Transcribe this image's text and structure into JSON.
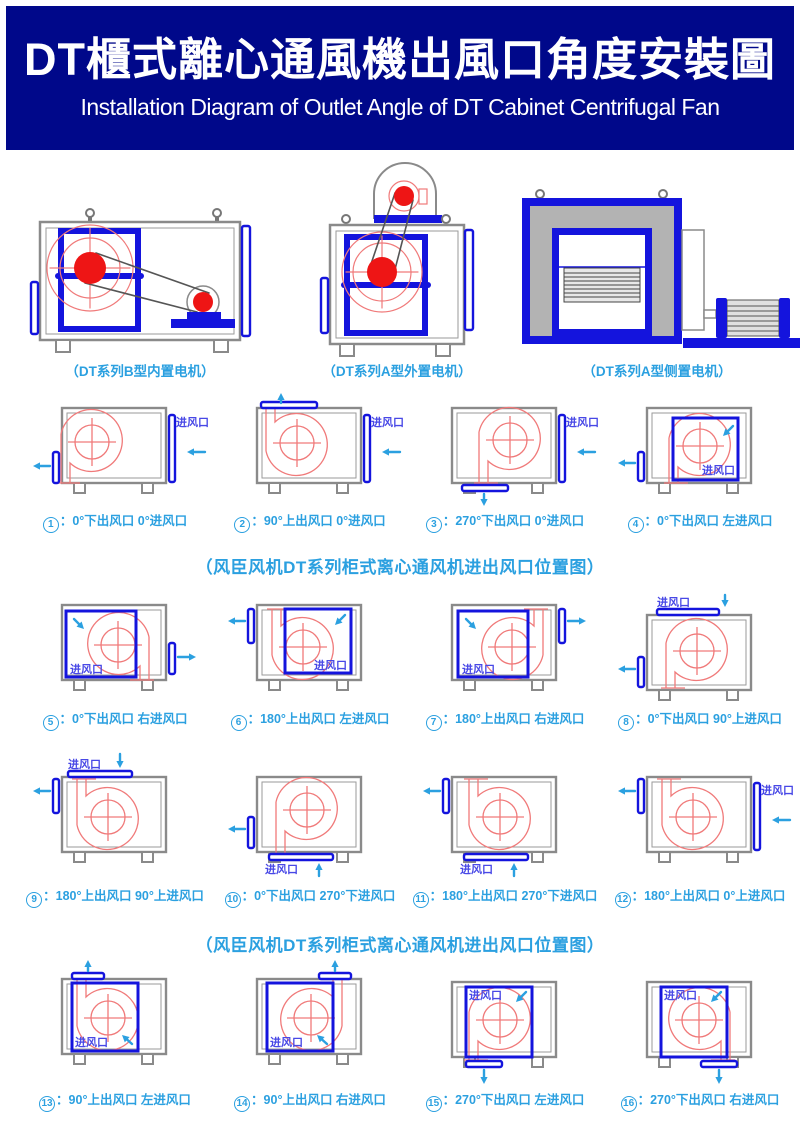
{
  "header": {
    "title_zh": "DT櫃式離心通風機出風口角度安裝圖",
    "subtitle_en": "Installation Diagram of Outlet Angle of DT Cabinet Centrifugal Fan"
  },
  "machine_captions": [
    "（DT系列B型内置电机）",
    "（DT系列A型外置电机）",
    "（DT系列A型侧置电机）"
  ],
  "section_title_mid": "（风臣风机DT系列柜式离心通风机进出风口位置图）",
  "section_title_bottom": "（风臣风机DT系列柜式离心通风机进出风口位置图）",
  "inlet_label": "进风口",
  "colors": {
    "header_bg": "#00088a",
    "caption_blue": "#2ba0e0",
    "port_blue": "#1414dd",
    "label_blue": "#4848e6",
    "scroll_red": "#f07a7a",
    "pulley_red": "#ee1515",
    "cabinet_gray": "#8a8a8a"
  },
  "diagrams": [
    {
      "n": "1",
      "cap": "0°下出风口 0°进风口",
      "row": 0,
      "col": 0,
      "cy": 16,
      "scroll": {
        "cx": 72,
        "cy": 50,
        "o": "bl",
        "dy": 41
      },
      "parts": [
        {
          "t": "vbar",
          "x": 33,
          "y": 60,
          "h": 31
        },
        {
          "t": "arrow",
          "x1": 30,
          "y1": 74,
          "x2": 13,
          "y2": 74
        },
        {
          "t": "vbar",
          "x": 149,
          "y": 23,
          "h": 67
        },
        {
          "t": "label",
          "x": 189,
          "y": 34,
          "a": "end"
        },
        {
          "t": "arrow",
          "x1": 185,
          "y1": 60,
          "x2": 167,
          "y2": 60
        }
      ]
    },
    {
      "n": "2",
      "cap": "90°上出风口 0°进风口",
      "row": 0,
      "col": 1,
      "cy": 16,
      "scroll": {
        "cx": 82,
        "cy": 51,
        "o": "tl",
        "dy": 41
      },
      "parts": [
        {
          "t": "hbar",
          "x": 46,
          "y": 10,
          "w": 56
        },
        {
          "t": "arrow",
          "x1": 66,
          "y1": 11,
          "x2": 66,
          "y2": 1
        },
        {
          "t": "vbar",
          "x": 149,
          "y": 23,
          "h": 67
        },
        {
          "t": "label",
          "x": 189,
          "y": 34,
          "a": "end"
        },
        {
          "t": "arrow",
          "x1": 185,
          "y1": 60,
          "x2": 167,
          "y2": 60
        }
      ]
    },
    {
      "n": "3",
      "cap": "270°下出风口 0°进风口",
      "row": 0,
      "col": 2,
      "cy": 16,
      "scroll": {
        "cx": 100,
        "cy": 48,
        "o": "bl",
        "dy": 43
      },
      "parts": [
        {
          "t": "hbar",
          "x": 52,
          "y": 93,
          "w": 46
        },
        {
          "t": "arrow",
          "x1": 74,
          "y1": 102,
          "x2": 74,
          "y2": 114
        },
        {
          "t": "vbar",
          "x": 149,
          "y": 23,
          "h": 67
        },
        {
          "t": "label",
          "x": 189,
          "y": 34,
          "a": "end"
        },
        {
          "t": "arrow",
          "x1": 185,
          "y1": 60,
          "x2": 167,
          "y2": 60
        }
      ]
    },
    {
      "n": "4",
      "cap": "0°下出风口 左进风口",
      "row": 0,
      "col": 3,
      "cy": 16,
      "scroll": {
        "cx": 95,
        "cy": 54,
        "o": "bl",
        "dy": 37
      },
      "parts": [
        {
          "t": "square",
          "x": 68,
          "y": 26,
          "w": 65,
          "h": 62
        },
        {
          "t": "label",
          "x": 130,
          "y": 82,
          "a": "end"
        },
        {
          "t": "diag",
          "x1": 128,
          "y1": 34,
          "x2": 118,
          "y2": 44
        },
        {
          "t": "vbar",
          "x": 33,
          "y": 60,
          "h": 29
        },
        {
          "t": "arrow",
          "x1": 30,
          "y1": 71,
          "x2": 13,
          "y2": 71
        }
      ]
    },
    {
      "n": "5",
      "cap": "0°下出风口 右进风口",
      "row": 1,
      "col": 0,
      "cy": 12,
      "scroll": {
        "cx": 98,
        "cy": 52,
        "o": "br",
        "dy": 35
      },
      "parts": [
        {
          "t": "square",
          "x": 46,
          "y": 18,
          "w": 70,
          "h": 66
        },
        {
          "t": "label",
          "x": 50,
          "y": 80,
          "a": "start"
        },
        {
          "t": "diag",
          "x1": 54,
          "y1": 26,
          "x2": 64,
          "y2": 36
        },
        {
          "t": "vbar",
          "x": 149,
          "y": 50,
          "h": 31
        },
        {
          "t": "arrow",
          "x1": 158,
          "y1": 64,
          "x2": 176,
          "y2": 64
        }
      ]
    },
    {
      "n": "6",
      "cap": "180°上出风口 左进风口",
      "row": 1,
      "col": 1,
      "cy": 12,
      "scroll": {
        "cx": 88,
        "cy": 54,
        "o": "tl",
        "dy": 38
      },
      "parts": [
        {
          "t": "square",
          "x": 70,
          "y": 16,
          "w": 66,
          "h": 64
        },
        {
          "t": "label",
          "x": 132,
          "y": 76,
          "a": "end"
        },
        {
          "t": "diag",
          "x1": 130,
          "y1": 22,
          "x2": 120,
          "y2": 32
        },
        {
          "t": "vbar",
          "x": 33,
          "y": 16,
          "h": 34
        },
        {
          "t": "arrow",
          "x1": 30,
          "y1": 28,
          "x2": 13,
          "y2": 28
        }
      ]
    },
    {
      "n": "7",
      "cap": "180°上出风口 右进风口",
      "row": 1,
      "col": 2,
      "cy": 12,
      "scroll": {
        "cx": 102,
        "cy": 54,
        "o": "tr",
        "dy": 38
      },
      "parts": [
        {
          "t": "square",
          "x": 48,
          "y": 18,
          "w": 70,
          "h": 66
        },
        {
          "t": "label",
          "x": 52,
          "y": 80,
          "a": "start"
        },
        {
          "t": "diag",
          "x1": 56,
          "y1": 26,
          "x2": 66,
          "y2": 36
        },
        {
          "t": "vbar",
          "x": 149,
          "y": 16,
          "h": 34
        },
        {
          "t": "arrow",
          "x1": 158,
          "y1": 28,
          "x2": 176,
          "y2": 28
        }
      ]
    },
    {
      "n": "8",
      "cap": "0°下出风口 90°上进风口",
      "row": 1,
      "col": 3,
      "cy": 22,
      "scroll": {
        "cx": 92,
        "cy": 58,
        "o": "bl",
        "dy": 37
      },
      "parts": [
        {
          "t": "hbar",
          "x": 52,
          "y": 16,
          "w": 62
        },
        {
          "t": "label",
          "x": 52,
          "y": 13,
          "a": "start"
        },
        {
          "t": "arrow",
          "x1": 120,
          "y1": 2,
          "x2": 120,
          "y2": 14
        },
        {
          "t": "vbar",
          "x": 33,
          "y": 64,
          "h": 30
        },
        {
          "t": "arrow",
          "x1": 30,
          "y1": 76,
          "x2": 13,
          "y2": 76
        }
      ]
    },
    {
      "n": "9",
      "cap": "180°上出风口 90°上进风口",
      "row": 2,
      "col": 0,
      "cy": 35,
      "scroll": {
        "cx": 88,
        "cy": 75,
        "o": "tl",
        "dy": 38
      },
      "parts": [
        {
          "t": "hbar",
          "x": 48,
          "y": 29,
          "w": 64
        },
        {
          "t": "label",
          "x": 48,
          "y": 26,
          "a": "start"
        },
        {
          "t": "arrow",
          "x1": 100,
          "y1": 12,
          "x2": 100,
          "y2": 26
        },
        {
          "t": "vbar",
          "x": 33,
          "y": 37,
          "h": 34
        },
        {
          "t": "arrow",
          "x1": 30,
          "y1": 49,
          "x2": 13,
          "y2": 49
        }
      ]
    },
    {
      "n": "10",
      "cap": "0°下出风口 270°下进风口",
      "row": 2,
      "col": 1,
      "cy": 35,
      "scroll": {
        "cx": 92,
        "cy": 68,
        "o": "bl",
        "dy": 44
      },
      "parts": [
        {
          "t": "vbar",
          "x": 33,
          "y": 75,
          "h": 31
        },
        {
          "t": "arrow",
          "x1": 30,
          "y1": 87,
          "x2": 13,
          "y2": 87
        },
        {
          "t": "hbar",
          "x": 54,
          "y": 112,
          "w": 64
        },
        {
          "t": "label",
          "x": 50,
          "y": 131,
          "a": "start"
        },
        {
          "t": "arrow",
          "x1": 104,
          "y1": 134,
          "x2": 104,
          "y2": 121
        }
      ]
    },
    {
      "n": "11",
      "cap": "180°上出风口 270°下进风口",
      "row": 2,
      "col": 2,
      "cy": 35,
      "scroll": {
        "cx": 90,
        "cy": 75,
        "o": "tl",
        "dy": 38
      },
      "parts": [
        {
          "t": "vbar",
          "x": 33,
          "y": 37,
          "h": 34
        },
        {
          "t": "arrow",
          "x1": 30,
          "y1": 49,
          "x2": 13,
          "y2": 49
        },
        {
          "t": "hbar",
          "x": 54,
          "y": 112,
          "w": 64
        },
        {
          "t": "label",
          "x": 50,
          "y": 131,
          "a": "start"
        },
        {
          "t": "arrow",
          "x1": 104,
          "y1": 134,
          "x2": 104,
          "y2": 121
        }
      ]
    },
    {
      "n": "12",
      "cap": "180°上出风口 0°上进风口",
      "row": 2,
      "col": 3,
      "cy": 35,
      "scroll": {
        "cx": 88,
        "cy": 75,
        "o": "tl",
        "dy": 38
      },
      "parts": [
        {
          "t": "vbar",
          "x": 33,
          "y": 37,
          "h": 34
        },
        {
          "t": "arrow",
          "x1": 30,
          "y1": 49,
          "x2": 13,
          "y2": 49
        },
        {
          "t": "vbar",
          "x": 149,
          "y": 41,
          "h": 67
        },
        {
          "t": "label",
          "x": 189,
          "y": 52,
          "a": "end"
        },
        {
          "t": "arrow",
          "x1": 185,
          "y1": 78,
          "x2": 167,
          "y2": 78
        }
      ]
    },
    {
      "n": "13",
      "cap": "90°上出风口 左进风口",
      "row": 3,
      "col": 0,
      "cy": 21,
      "scroll": {
        "cx": 88,
        "cy": 60,
        "o": "tl",
        "dy": 39
      },
      "parts": [
        {
          "t": "hbar",
          "x": 52,
          "y": 15,
          "w": 32
        },
        {
          "t": "arrow",
          "x1": 68,
          "y1": 13,
          "x2": 68,
          "y2": 2
        },
        {
          "t": "square",
          "x": 52,
          "y": 25,
          "w": 66,
          "h": 68
        },
        {
          "t": "label",
          "x": 55,
          "y": 88,
          "a": "start"
        },
        {
          "t": "diag",
          "x1": 112,
          "y1": 86,
          "x2": 102,
          "y2": 77
        }
      ]
    },
    {
      "n": "14",
      "cap": "90°上出风口 右进风口",
      "row": 3,
      "col": 1,
      "cy": 21,
      "scroll": {
        "cx": 96,
        "cy": 60,
        "o": "tr",
        "dy": 39
      },
      "parts": [
        {
          "t": "hbar",
          "x": 104,
          "y": 15,
          "w": 32
        },
        {
          "t": "arrow",
          "x1": 120,
          "y1": 13,
          "x2": 120,
          "y2": 2
        },
        {
          "t": "square",
          "x": 52,
          "y": 25,
          "w": 66,
          "h": 68
        },
        {
          "t": "label",
          "x": 55,
          "y": 88,
          "a": "start"
        },
        {
          "t": "diag",
          "x1": 112,
          "y1": 86,
          "x2": 102,
          "y2": 77
        }
      ]
    },
    {
      "n": "15",
      "cap": "270°下出风口 左进风口",
      "row": 3,
      "col": 2,
      "cy": 24,
      "scroll": {
        "cx": 90,
        "cy": 62,
        "o": "bl",
        "dy": 40
      },
      "parts": [
        {
          "t": "square",
          "x": 56,
          "y": 29,
          "w": 66,
          "h": 70
        },
        {
          "t": "label",
          "x": 59,
          "y": 41,
          "a": "start"
        },
        {
          "t": "diag",
          "x1": 116,
          "y1": 34,
          "x2": 106,
          "y2": 44
        },
        {
          "t": "hbar",
          "x": 56,
          "y": 103,
          "w": 36
        },
        {
          "t": "arrow",
          "x1": 74,
          "y1": 112,
          "x2": 74,
          "y2": 126
        }
      ]
    },
    {
      "n": "16",
      "cap": "270°下出风口 右进风口",
      "row": 3,
      "col": 3,
      "cy": 24,
      "scroll": {
        "cx": 94,
        "cy": 62,
        "o": "br",
        "dy": 40
      },
      "parts": [
        {
          "t": "square",
          "x": 56,
          "y": 29,
          "w": 66,
          "h": 70
        },
        {
          "t": "label",
          "x": 59,
          "y": 41,
          "a": "start"
        },
        {
          "t": "diag",
          "x1": 116,
          "y1": 34,
          "x2": 106,
          "y2": 44
        },
        {
          "t": "hbar",
          "x": 96,
          "y": 103,
          "w": 36
        },
        {
          "t": "arrow",
          "x1": 114,
          "y1": 112,
          "x2": 114,
          "y2": 126
        }
      ]
    }
  ]
}
